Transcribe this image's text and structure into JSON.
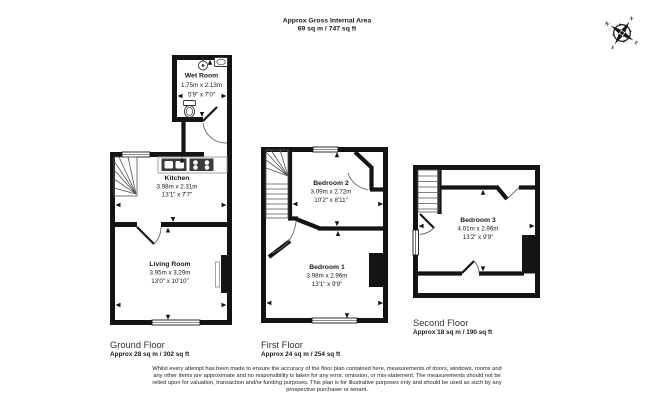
{
  "header": {
    "title": "Approx Gross Internal Area",
    "area": "69 sq m / 747 sq ft"
  },
  "compass": {
    "north": "N",
    "east": "E",
    "south": "S",
    "west": "W"
  },
  "floors": [
    {
      "title": "Ground Floor",
      "area": "Approx 28 sq m / 302 sq ft"
    },
    {
      "title": "First Floor",
      "area": "Approx 24 sq m / 254 sq ft"
    },
    {
      "title": "Second Floor",
      "area": "Approx 18 sq m / 190 sq ft"
    }
  ],
  "rooms": {
    "wet_room": {
      "name": "Wet Room",
      "metric": "1.75m x 2.13m",
      "imperial": "5'9\" x 7'0\""
    },
    "kitchen": {
      "name": "Kitchen",
      "metric": "3.98m x 2.31m",
      "imperial": "13'1\" x 7'7\""
    },
    "living_room": {
      "name": "Living Room",
      "metric": "3.95m x 3.29m",
      "imperial": "13'0\" x 10'10\""
    },
    "bedroom_1": {
      "name": "Bedroom 1",
      "metric": "3.98m x 2.96m",
      "imperial": "13'1\" x 9'9\""
    },
    "bedroom_2": {
      "name": "Bedroom 2",
      "metric": "3.09m x 2.72m",
      "imperial": "10'2\" x 8'11\""
    },
    "bedroom_3": {
      "name": "Bedroom 3",
      "metric": "4.01m x 2.96m",
      "imperial": "13'2\" x 9'9\""
    }
  },
  "disclaimer": "Whilst every attempt has been made to ensure the accuracy of the floor plan contained here, measurements of doors, windows, rooms and any other items are approximate and no responsibility is taken for any error, omission, or mis-statement. The measurements should not be relied upon for valuation, transaction and/or funding purposes. This plan is for illustrative purposes only and should be used as such by any prospective purchaser or tenant.",
  "colors": {
    "wall": "#141414",
    "background": "#ffffff"
  }
}
